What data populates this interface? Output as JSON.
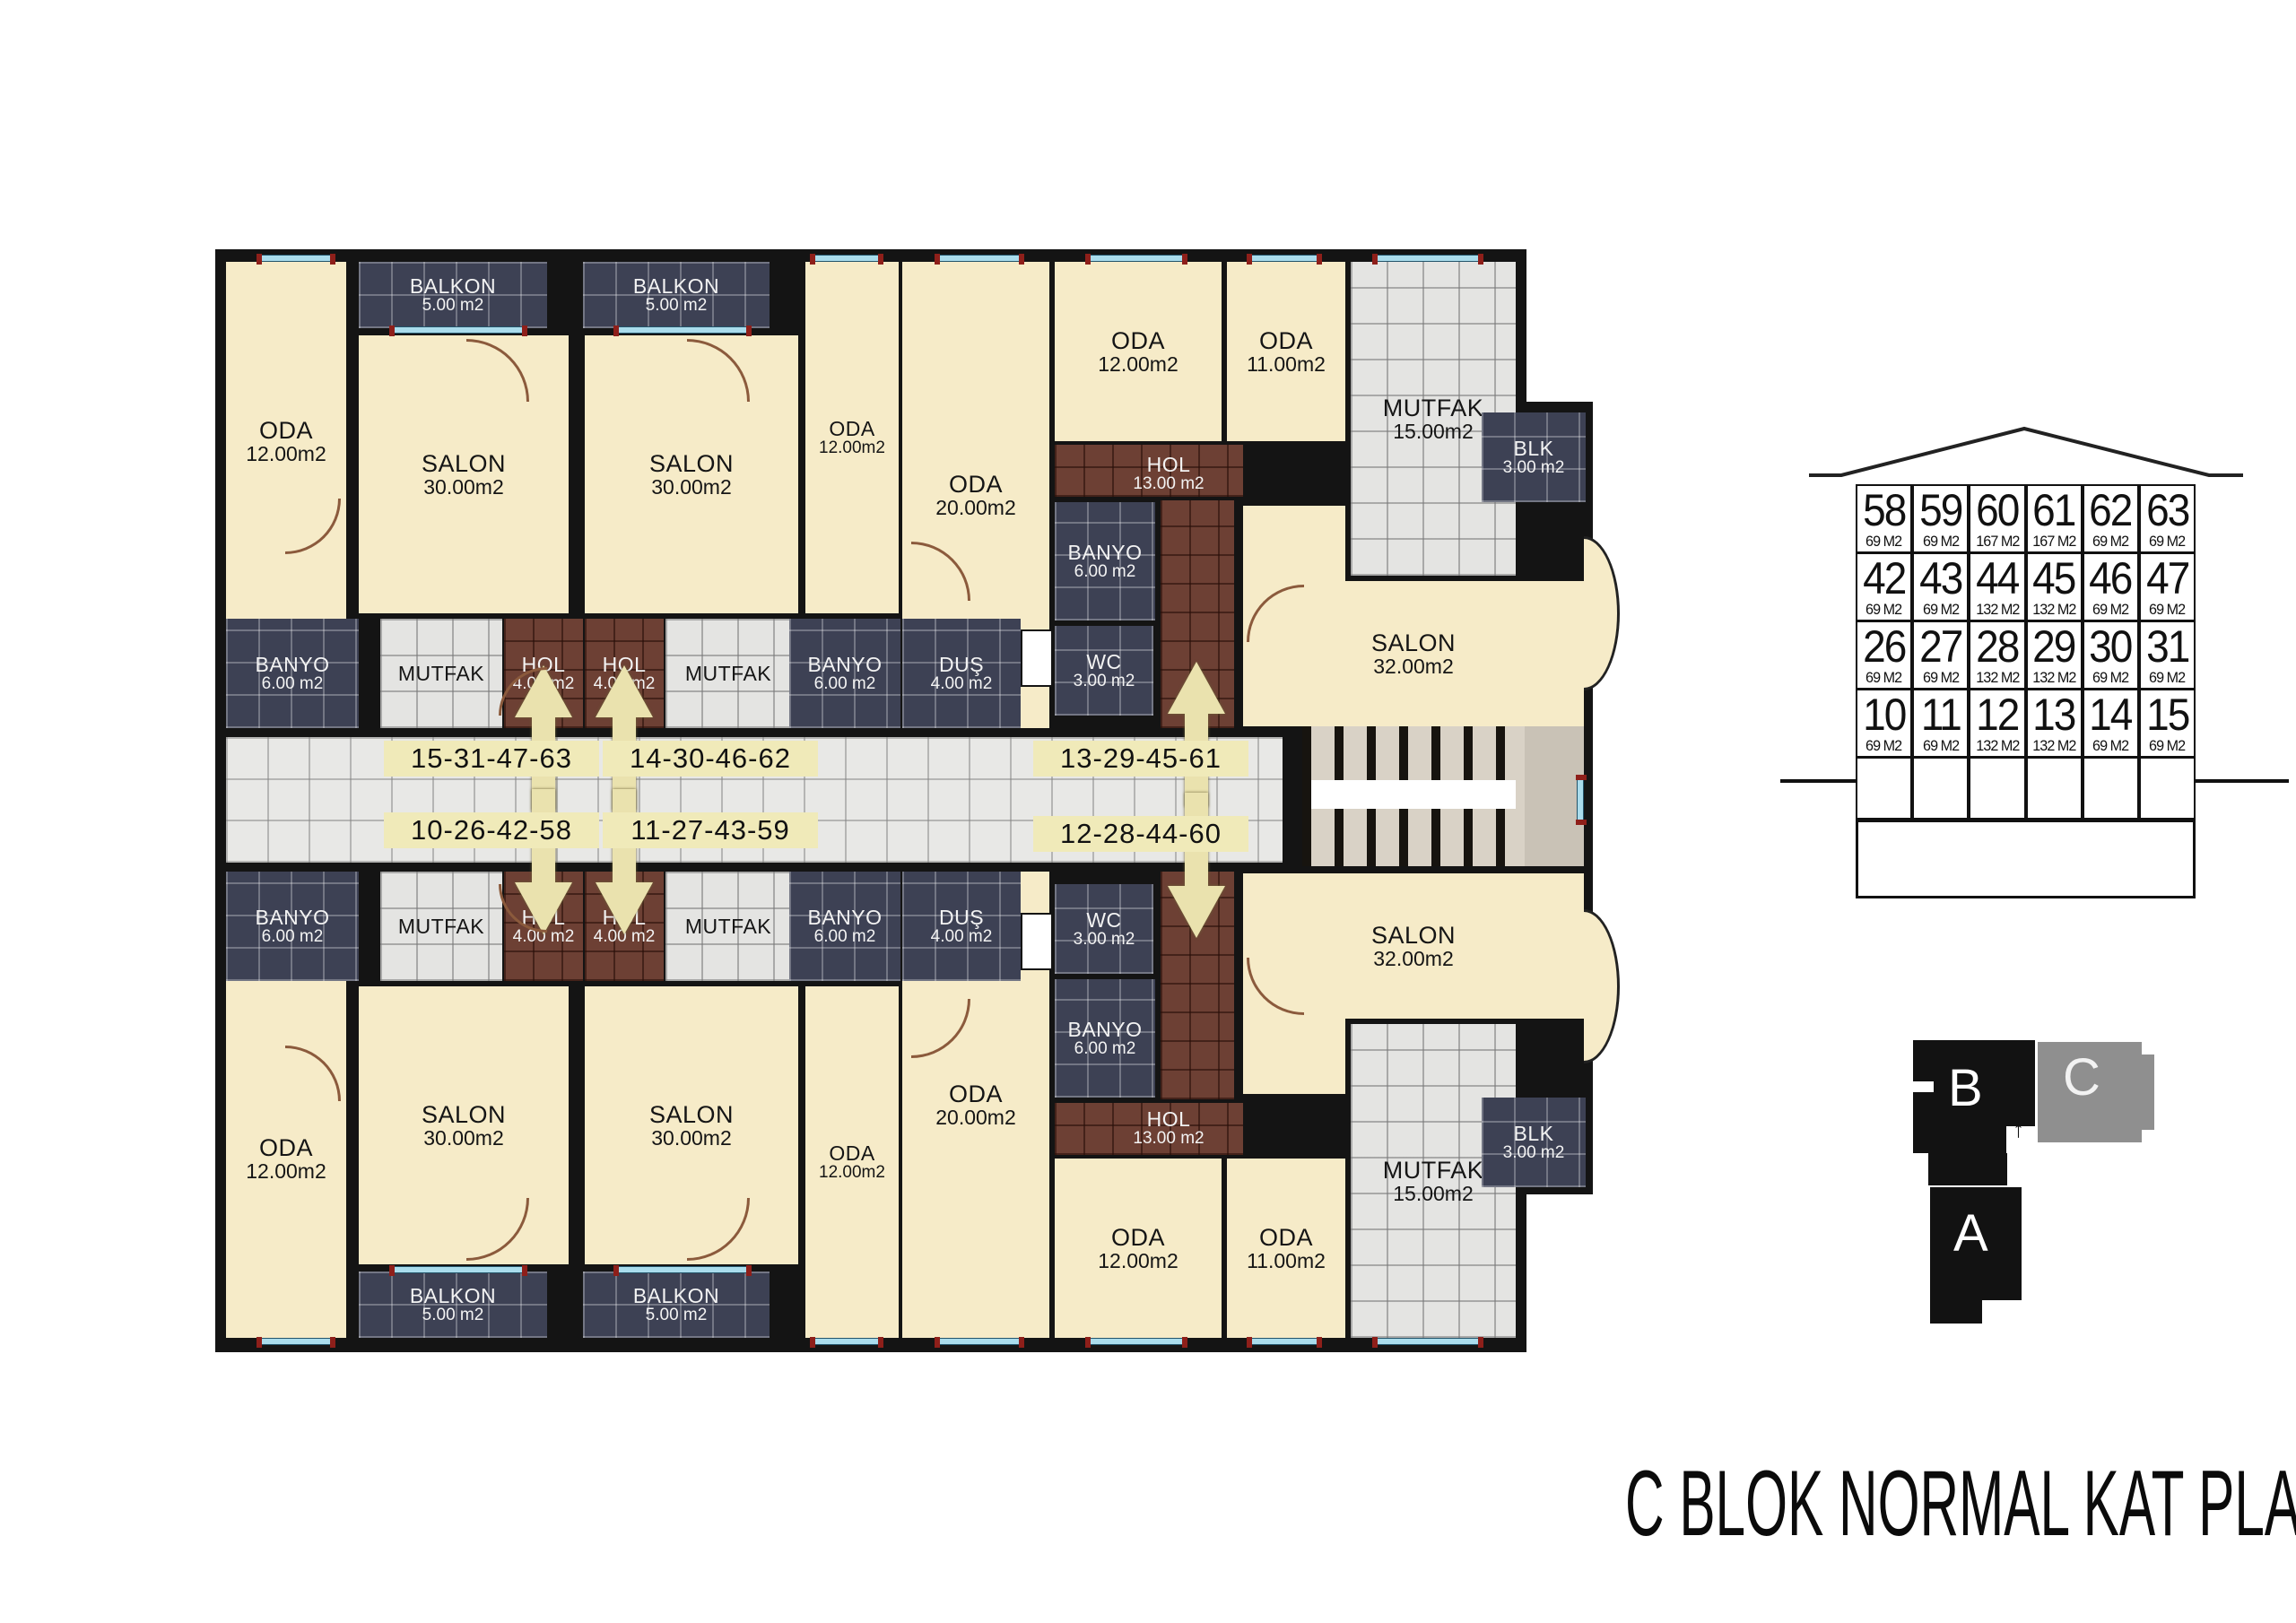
{
  "title": "C BLOK NORMAL KAT PLANI",
  "rooms": {
    "oda12": {
      "name": "ODA",
      "area": "12.00m2"
    },
    "oda20": {
      "name": "ODA",
      "area": "20.00m2"
    },
    "oda11": {
      "name": "ODA",
      "area": "11.00m2"
    },
    "salon30": {
      "name": "SALON",
      "area": "30.00m2"
    },
    "salon32": {
      "name": "SALON",
      "area": "32.00m2"
    },
    "balkon": {
      "name": "BALKON",
      "area": "5.00 m2"
    },
    "mutfak": {
      "name": "MUTFAK",
      "area": ""
    },
    "mutfak15": {
      "name": "MUTFAK",
      "area": "15.00m2"
    },
    "banyo": {
      "name": "BANYO",
      "area": "6.00 m2"
    },
    "dus": {
      "name": "DUŞ",
      "area": "4.00 m2"
    },
    "wc": {
      "name": "WC",
      "area": "3.00 m2"
    },
    "hol4": {
      "name": "HOL",
      "area": "4.00 m2"
    },
    "hol13": {
      "name": "HOL",
      "area": "13.00 m2"
    },
    "blk": {
      "name": "BLK",
      "area": "3.00 m2"
    }
  },
  "corridor": {
    "top_left": "15-31-47-63",
    "top_mid": "14-30-46-62",
    "top_right": "13-29-45-61",
    "bottom_left": "10-26-42-58",
    "bottom_mid": "11-27-43-59",
    "bottom_right": "12-28-44-60"
  },
  "schematic": {
    "rows": [
      [
        {
          "no": "58",
          "area": "69 M2"
        },
        {
          "no": "59",
          "area": "69 M2"
        },
        {
          "no": "60",
          "area": "167 M2"
        },
        {
          "no": "61",
          "area": "167 M2"
        },
        {
          "no": "62",
          "area": "69 M2"
        },
        {
          "no": "63",
          "area": "69 M2"
        }
      ],
      [
        {
          "no": "42",
          "area": "69 M2"
        },
        {
          "no": "43",
          "area": "69 M2"
        },
        {
          "no": "44",
          "area": "132 M2"
        },
        {
          "no": "45",
          "area": "132 M2"
        },
        {
          "no": "46",
          "area": "69 M2"
        },
        {
          "no": "47",
          "area": "69 M2"
        }
      ],
      [
        {
          "no": "26",
          "area": "69 M2"
        },
        {
          "no": "27",
          "area": "69 M2"
        },
        {
          "no": "28",
          "area": "132 M2"
        },
        {
          "no": "29",
          "area": "132 M2"
        },
        {
          "no": "30",
          "area": "69 M2"
        },
        {
          "no": "31",
          "area": "69 M2"
        }
      ],
      [
        {
          "no": "10",
          "area": "69 M2"
        },
        {
          "no": "11",
          "area": "69 M2"
        },
        {
          "no": "12",
          "area": "132 M2"
        },
        {
          "no": "13",
          "area": "132 M2"
        },
        {
          "no": "14",
          "area": "69 M2"
        },
        {
          "no": "15",
          "area": "69 M2"
        }
      ]
    ]
  },
  "site": {
    "a": "A",
    "b": "B",
    "c": "C",
    "north_arrow": "↑"
  }
}
